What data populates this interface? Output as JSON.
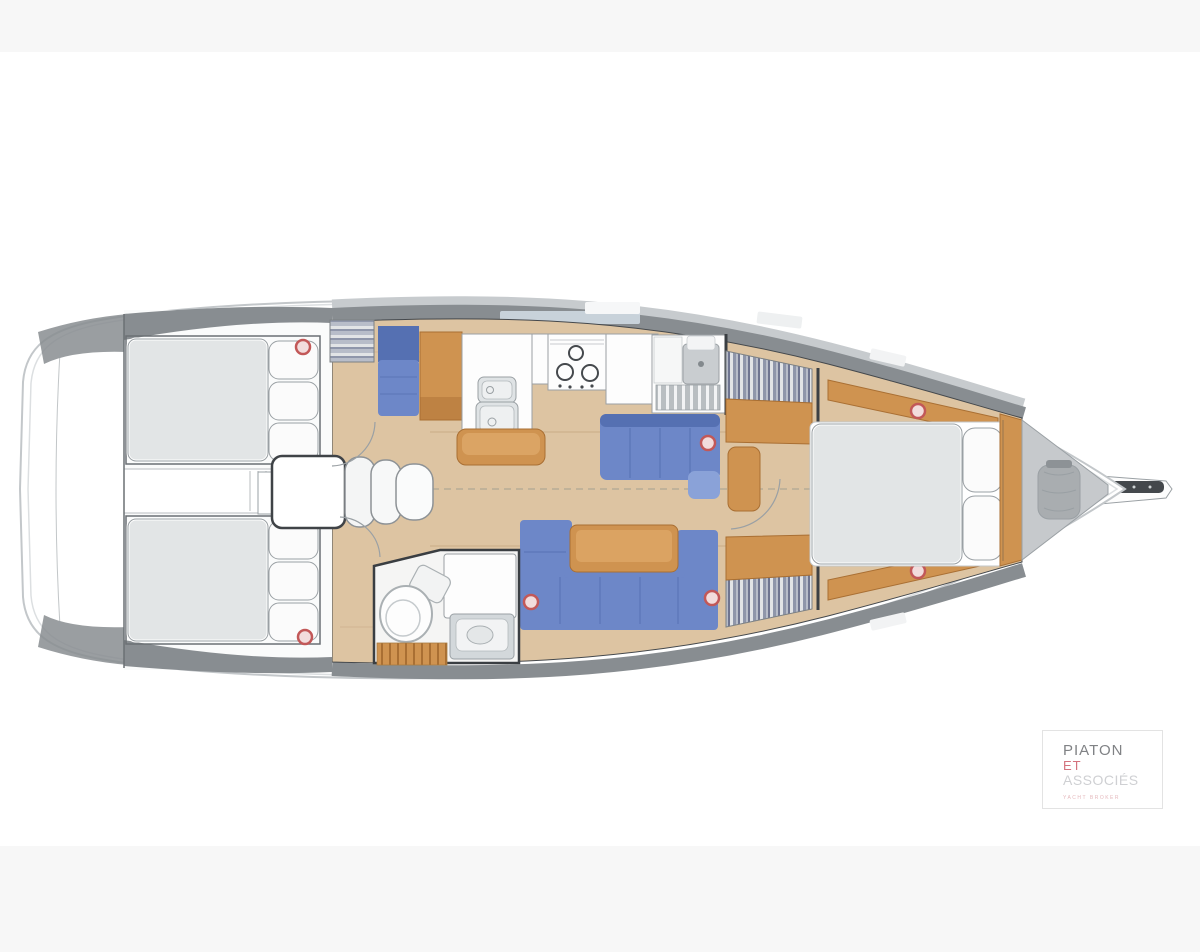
{
  "page": {
    "background": "#f7f7f7",
    "photo_background": "#ffffff"
  },
  "palette": {
    "page-bg": "#f7f7f7",
    "photo-bg": "#ffffff",
    "hull": "#ffffff",
    "hull-line": "#c3c7ca",
    "hull-inner": "#dcdfe1",
    "deck-dark": "#888d91",
    "deck-light": "#c7cbce",
    "wood-floor": "#ddc4a2",
    "plank": "#c9ab85",
    "wood": "#cf9350",
    "wood-light": "#e2ae6e",
    "wood-edge": "#a96f33",
    "blue": "#6d87c8",
    "blue-dark": "#5570b2",
    "blue-light": "#8aa2d8",
    "mattress": "#e2e5e6",
    "pillow": "#fbfbfb",
    "white-furn": "#fdfdfd",
    "steel": "#dfe3e5",
    "gray-line": "#9aa0a4",
    "dark-line": "#44484c",
    "anchor-gray": "#c6c9cc",
    "bag-gray": "#a9adb0",
    "ring": "#c25858",
    "ring-fill": "#f2dcdc",
    "stripe-a": "#e2e4e6",
    "stripe-b": "#8f96aa",
    "stripe-c": "#b8bdc9",
    "stripe-d": "#6f7590",
    "logo-border": "#e3e3e3",
    "logo-name": "#808285",
    "logo-et": "#d4737e",
    "logo-assoc": "#cfd0d3",
    "logo-tag": "#e5b9bd"
  },
  "plan": {
    "type": "sailboat-interior-floor-plan",
    "orientation": "bow-right",
    "features": [
      "aft-cabin-port-double-berth",
      "aft-cabin-starboard-double-berth",
      "engine-compartment",
      "companionway-steps",
      "galley-double-sink",
      "galley-stove-3-burners",
      "chart-seat",
      "forward-head-with-shower",
      "aft-head-with-toilet",
      "saloon-l-settee",
      "saloon-u-settee-with-table",
      "hanging-lockers",
      "owner-cabin-island-berth",
      "anchor-locker",
      "bowsprit",
      "hull-portholes"
    ]
  },
  "logo": {
    "line1": "PIATON",
    "line2": "ET",
    "line3": "ASSOCIÉS",
    "tagline": "YACHT BROKER"
  }
}
